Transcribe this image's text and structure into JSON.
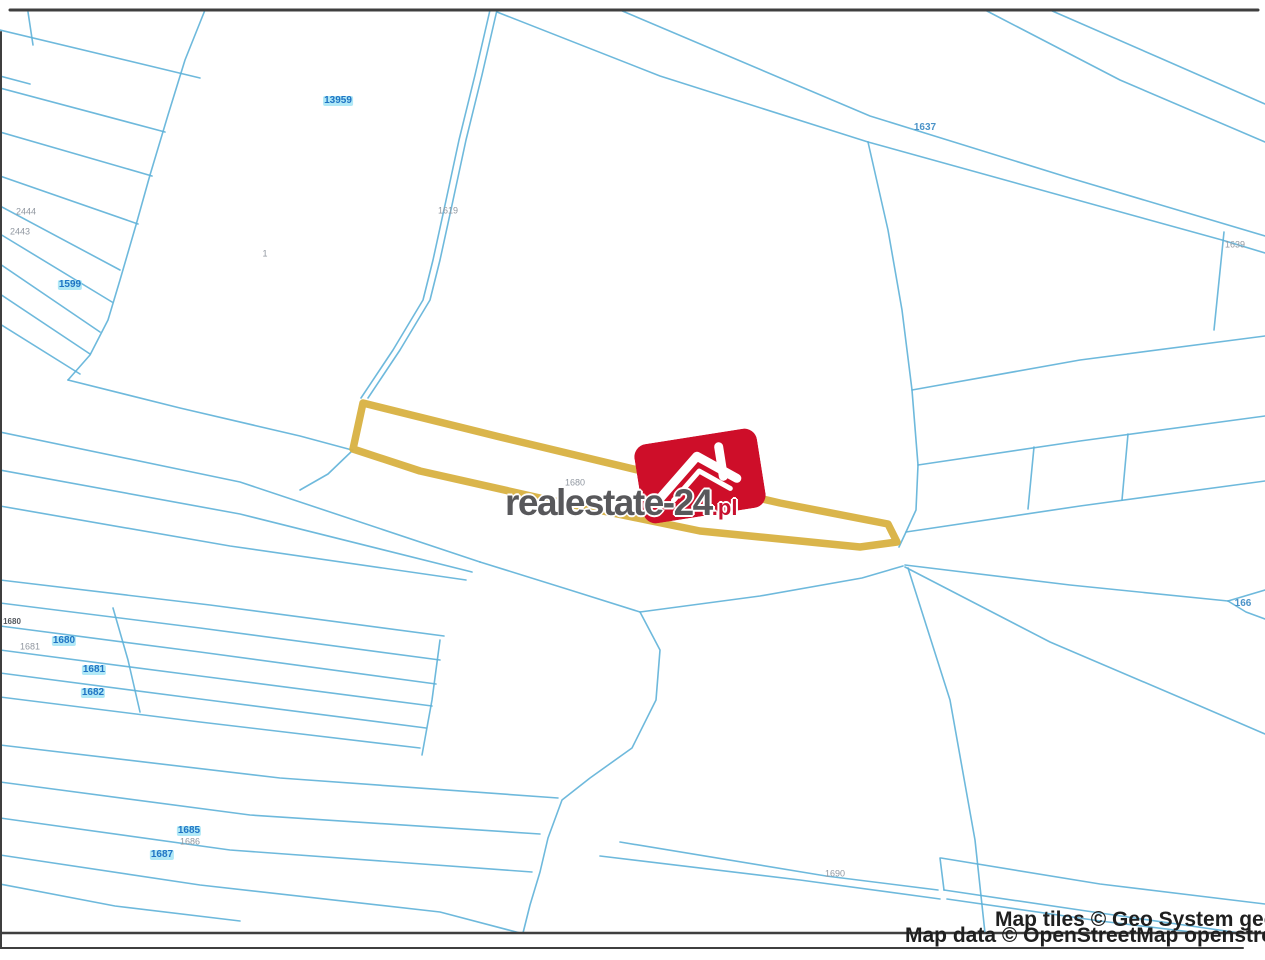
{
  "watermark": {
    "brand_text": "realestate-24",
    "tld_text": ".pl",
    "logo_icon": "house-icon",
    "colors": {
      "logo_red": "#ce0e29",
      "text_gray": "#58585b",
      "tld_red": "#c8102e"
    }
  },
  "attribution": {
    "line1": "Map tiles © Geo System geo-s",
    "line2": "Map data © OpenStreetMap openstreet"
  },
  "map": {
    "colors": {
      "background": "#ffffff",
      "parcel_line": "#5eb1d8",
      "frame": "#3f3f3f",
      "highlight": "#d8b141"
    },
    "frame_lines": [
      {
        "points": [
          [
            10,
            10
          ],
          [
            1258,
            10
          ]
        ],
        "width": 3
      },
      {
        "points": [
          [
            1,
            32
          ],
          [
            1,
            948
          ]
        ],
        "width": 2
      },
      {
        "points": [
          [
            0,
            933
          ],
          [
            1265,
            933
          ]
        ],
        "width": 2.5
      },
      {
        "points": [
          [
            0,
            948
          ],
          [
            1243,
            948
          ]
        ],
        "width": 2
      }
    ],
    "highlight_parcel": {
      "points": [
        [
          363,
          403
        ],
        [
          500,
          437
        ],
        [
          650,
          473
        ],
        [
          780,
          503
        ],
        [
          888,
          524
        ],
        [
          897,
          542
        ],
        [
          860,
          547
        ],
        [
          700,
          531
        ],
        [
          540,
          498
        ],
        [
          420,
          471
        ],
        [
          353,
          449
        ]
      ],
      "stroke_width": 7.5
    },
    "parcel_lines": [
      [
        [
          0,
          30
        ],
        [
          200,
          78
        ]
      ],
      [
        [
          28,
          12
        ],
        [
          33,
          45
        ]
      ],
      [
        [
          0,
          76
        ],
        [
          30,
          84
        ]
      ],
      [
        [
          205,
          10
        ],
        [
          185,
          60
        ],
        [
          168,
          115
        ],
        [
          150,
          175
        ],
        [
          136,
          225
        ],
        [
          120,
          280
        ],
        [
          108,
          320
        ],
        [
          90,
          355
        ],
        [
          68,
          380
        ]
      ],
      [
        [
          68,
          380
        ],
        [
          180,
          408
        ],
        [
          300,
          436
        ],
        [
          352,
          450
        ]
      ],
      [
        [
          0,
          88
        ],
        [
          165,
          132
        ]
      ],
      [
        [
          0,
          132
        ],
        [
          152,
          176
        ]
      ],
      [
        [
          0,
          176
        ],
        [
          138,
          224
        ]
      ],
      [
        [
          0,
          206
        ],
        [
          120,
          270
        ]
      ],
      [
        [
          0,
          234
        ],
        [
          112,
          302
        ]
      ],
      [
        [
          0,
          264
        ],
        [
          100,
          332
        ]
      ],
      [
        [
          0,
          294
        ],
        [
          90,
          354
        ]
      ],
      [
        [
          0,
          324
        ],
        [
          80,
          374
        ]
      ],
      [
        [
          497,
          10
        ],
        [
          482,
          75
        ],
        [
          466,
          140
        ],
        [
          452,
          205
        ],
        [
          440,
          260
        ],
        [
          430,
          300
        ],
        [
          400,
          350
        ],
        [
          368,
          398
        ]
      ],
      [
        [
          490,
          10
        ],
        [
          475,
          75
        ],
        [
          459,
          140
        ],
        [
          445,
          205
        ],
        [
          433,
          260
        ],
        [
          423,
          300
        ],
        [
          393,
          350
        ],
        [
          361,
          398
        ]
      ],
      [
        [
          353,
          450
        ],
        [
          328,
          474
        ],
        [
          300,
          490
        ]
      ],
      [
        [
          497,
          12
        ],
        [
          660,
          76
        ],
        [
          868,
          142
        ]
      ],
      [
        [
          620,
          10
        ],
        [
          870,
          116
        ],
        [
          1070,
          178
        ],
        [
          1265,
          236
        ]
      ],
      [
        [
          1050,
          10
        ],
        [
          1160,
          58
        ],
        [
          1265,
          104
        ]
      ],
      [
        [
          985,
          10
        ],
        [
          1120,
          80
        ],
        [
          1265,
          142
        ]
      ],
      [
        [
          868,
          142
        ],
        [
          1070,
          198
        ],
        [
          1222,
          240
        ],
        [
          1265,
          253
        ]
      ],
      [
        [
          1224,
          232
        ],
        [
          1214,
          330
        ]
      ],
      [
        [
          868,
          142
        ],
        [
          888,
          230
        ],
        [
          902,
          310
        ],
        [
          912,
          390
        ],
        [
          918,
          465
        ],
        [
          916,
          510
        ],
        [
          906,
          532
        ],
        [
          899,
          547
        ]
      ],
      [
        [
          912,
          390
        ],
        [
          1080,
          360
        ],
        [
          1265,
          336
        ]
      ],
      [
        [
          918,
          465
        ],
        [
          1080,
          441
        ],
        [
          1265,
          416
        ]
      ],
      [
        [
          906,
          532
        ],
        [
          1080,
          506
        ],
        [
          1265,
          481
        ]
      ],
      [
        [
          1034,
          447
        ],
        [
          1028,
          509
        ]
      ],
      [
        [
          1128,
          434
        ],
        [
          1122,
          500
        ]
      ],
      [
        [
          0,
          432
        ],
        [
          240,
          482
        ],
        [
          480,
          562
        ]
      ],
      [
        [
          0,
          470
        ],
        [
          240,
          514
        ],
        [
          472,
          572
        ]
      ],
      [
        [
          0,
          506
        ],
        [
          230,
          546
        ],
        [
          466,
          580
        ]
      ],
      [
        [
          480,
          562
        ],
        [
          570,
          590
        ],
        [
          640,
          612
        ],
        [
          660,
          650
        ],
        [
          656,
          700
        ],
        [
          632,
          748
        ],
        [
          590,
          778
        ],
        [
          562,
          800
        ],
        [
          548,
          838
        ],
        [
          540,
          872
        ],
        [
          530,
          905
        ],
        [
          523,
          933
        ]
      ],
      [
        [
          640,
          612
        ],
        [
          760,
          596
        ],
        [
          862,
          578
        ],
        [
          903,
          566
        ]
      ],
      [
        [
          905,
          565
        ],
        [
          1070,
          585
        ],
        [
          1228,
          601
        ]
      ],
      [
        [
          1228,
          601
        ],
        [
          1265,
          590
        ]
      ],
      [
        [
          1228,
          601
        ],
        [
          1246,
          612
        ],
        [
          1265,
          619
        ]
      ],
      [
        [
          905,
          567
        ],
        [
          1050,
          642
        ],
        [
          1200,
          706
        ],
        [
          1265,
          734
        ]
      ],
      [
        [
          908,
          568
        ],
        [
          950,
          700
        ],
        [
          975,
          840
        ],
        [
          985,
          933
        ]
      ],
      [
        [
          0,
          580
        ],
        [
          210,
          605
        ],
        [
          444,
          636
        ]
      ],
      [
        [
          0,
          603
        ],
        [
          200,
          628
        ],
        [
          440,
          660
        ]
      ],
      [
        [
          0,
          626
        ],
        [
          200,
          652
        ],
        [
          436,
          684
        ]
      ],
      [
        [
          0,
          650
        ],
        [
          200,
          676
        ],
        [
          432,
          706
        ]
      ],
      [
        [
          0,
          673
        ],
        [
          200,
          699
        ],
        [
          426,
          728
        ]
      ],
      [
        [
          0,
          697
        ],
        [
          200,
          722
        ],
        [
          420,
          748
        ]
      ],
      [
        [
          113,
          608
        ],
        [
          128,
          660
        ],
        [
          140,
          712
        ]
      ],
      [
        [
          440,
          640
        ],
        [
          432,
          700
        ],
        [
          422,
          755
        ]
      ],
      [
        [
          0,
          745
        ],
        [
          280,
          778
        ],
        [
          558,
          798
        ]
      ],
      [
        [
          0,
          782
        ],
        [
          250,
          815
        ],
        [
          540,
          834
        ]
      ],
      [
        [
          0,
          818
        ],
        [
          230,
          850
        ],
        [
          532,
          872
        ]
      ],
      [
        [
          0,
          855
        ],
        [
          200,
          885
        ],
        [
          440,
          912
        ],
        [
          520,
          933
        ]
      ],
      [
        [
          0,
          884
        ],
        [
          115,
          906
        ],
        [
          240,
          921
        ]
      ],
      [
        [
          620,
          842
        ],
        [
          826,
          876
        ],
        [
          938,
          890
        ]
      ],
      [
        [
          600,
          856
        ],
        [
          800,
          880
        ],
        [
          940,
          899
        ]
      ],
      [
        [
          940,
          858
        ],
        [
          944,
          890
        ]
      ],
      [
        [
          944,
          890
        ],
        [
          1100,
          913
        ],
        [
          1240,
          933
        ]
      ],
      [
        [
          947,
          899
        ],
        [
          1100,
          921
        ],
        [
          1200,
          933
        ]
      ],
      [
        [
          941,
          858
        ],
        [
          1100,
          884
        ],
        [
          1265,
          904
        ]
      ]
    ],
    "labels": [
      {
        "text": "13959",
        "x": 338,
        "y": 101,
        "style": "hl"
      },
      {
        "text": "2444",
        "x": 26,
        "y": 212,
        "style": "faint"
      },
      {
        "text": "2443",
        "x": 20,
        "y": 232,
        "style": "faint"
      },
      {
        "text": "1599",
        "x": 70,
        "y": 285,
        "style": "hl"
      },
      {
        "text": "1",
        "x": 265,
        "y": 254,
        "style": "faint"
      },
      {
        "text": "1619",
        "x": 448,
        "y": 211,
        "style": "faint"
      },
      {
        "text": "1637",
        "x": 925,
        "y": 128,
        "style": "blue"
      },
      {
        "text": "1639",
        "x": 1235,
        "y": 245,
        "style": "faint"
      },
      {
        "text": "1680",
        "x": 575,
        "y": 483,
        "style": "faint"
      },
      {
        "text": "1680",
        "x": 12,
        "y": 622,
        "style": "dark"
      },
      {
        "text": "1681",
        "x": 30,
        "y": 647,
        "style": "faint"
      },
      {
        "text": "1680",
        "x": 64,
        "y": 641,
        "style": "hl"
      },
      {
        "text": "1681",
        "x": 94,
        "y": 670,
        "style": "hl"
      },
      {
        "text": "1682",
        "x": 93,
        "y": 693,
        "style": "hl"
      },
      {
        "text": "1685",
        "x": 189,
        "y": 831,
        "style": "hl"
      },
      {
        "text": "1686",
        "x": 190,
        "y": 842,
        "style": "faint"
      },
      {
        "text": "1687",
        "x": 162,
        "y": 855,
        "style": "hl"
      },
      {
        "text": "1690",
        "x": 835,
        "y": 874,
        "style": "faint"
      },
      {
        "text": "166",
        "x": 1243,
        "y": 604,
        "style": "blue"
      }
    ]
  }
}
